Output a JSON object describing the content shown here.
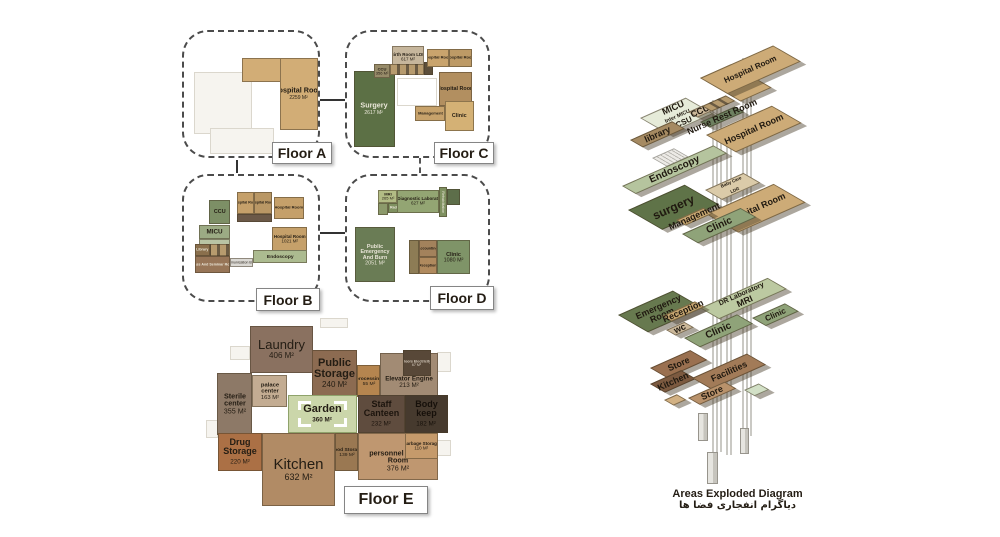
{
  "floor_a": {
    "label": "Floor A",
    "rooms": {
      "hospital_room": {
        "name": "Hospital Room",
        "area": "2259 M²"
      }
    }
  },
  "floor_b": {
    "label": "Floor B",
    "rooms": {
      "ccu": {
        "name": "CCU"
      },
      "micu": {
        "name": "MICU"
      },
      "hospital_room_1": {
        "name": "Hospital Room"
      },
      "hospital_room_2": {
        "name": "Hospital Room"
      },
      "hospital_room_3": {
        "name": "Hospital Room"
      },
      "hospital_room_4": {
        "name": "Hospital Room",
        "area": "1021 M²"
      },
      "library": {
        "name": "Library"
      },
      "class_seminar": {
        "name": "Class And Seminar Room"
      },
      "communication_bridge": {
        "name": "Communication Bridge"
      },
      "endoscopy": {
        "name": "Endoscopy"
      }
    }
  },
  "floor_c": {
    "label": "Floor C",
    "rooms": {
      "surgery": {
        "name": "Surgery",
        "area": "2617 M²"
      },
      "birth_room": {
        "name": "Birth Room LDR",
        "area": "617 M²"
      },
      "ccu": {
        "name": "CCU",
        "area": "356 M²"
      },
      "hospital_room_1": {
        "name": "Hospital Room"
      },
      "hospital_room_2": {
        "name": "Hospital Room"
      },
      "hospital_room_3": {
        "name": "Hospital Room"
      },
      "management": {
        "name": "Management"
      },
      "clinic": {
        "name": "Clinic"
      }
    }
  },
  "floor_d": {
    "label": "Floor D",
    "rooms": {
      "mri": {
        "name": "MRI",
        "area": "265 M²"
      },
      "radiology": {
        "name": "Radiology"
      },
      "diagnostic_lab": {
        "name": "Dr Diagnostic Laboratory",
        "area": "627 M²"
      },
      "rehabilitation": {
        "name": "Rehabilitation"
      },
      "emergency": {
        "name": "Public Emergency And Burn",
        "area": "2051 M²"
      },
      "accounting": {
        "name": "Accounting"
      },
      "reception": {
        "name": "Reception"
      },
      "clinic": {
        "name": "Clinic",
        "area": "1080 M²"
      }
    }
  },
  "floor_e": {
    "label": "Floor E",
    "rooms": {
      "laundry": {
        "name": "Laundry",
        "area": "406 M²"
      },
      "public_storage": {
        "name": "Public Storage",
        "area": "240 M²"
      },
      "processing": {
        "name": "processing",
        "area": "55 M²"
      },
      "floors_electricity": {
        "name": "Floors Electricity",
        "area": "67 M²"
      },
      "elevator_engine": {
        "name": "Elevator Engine",
        "area": "213 M²"
      },
      "sterile_center": {
        "name": "Sterile center",
        "area": "355 M²"
      },
      "palace_center": {
        "name": "palace center",
        "area": "163 M²"
      },
      "garden": {
        "name": "Garden",
        "area": "360 M²"
      },
      "staff_canteen": {
        "name": "Staff Canteen",
        "area": "232 M²"
      },
      "body_keep": {
        "name": "Body keep",
        "area": "182 M²"
      },
      "drug_storage": {
        "name": "Drug Storage",
        "area": "220 M²"
      },
      "kitchen": {
        "name": "Kitchen",
        "area": "632 M²"
      },
      "food_storage": {
        "name": "Food Storage",
        "area": "139 M²"
      },
      "personnel_locker": {
        "name": "personnel locker Room",
        "area": "376 M²"
      },
      "garbage_storage": {
        "name": "Garbage Storage",
        "area": "110 M²"
      }
    }
  },
  "exploded": {
    "title": "Areas  Exploded Diagram",
    "subtitle": "دیاگرام انفجاری فضا ها",
    "plates": {
      "hospital_room_top": "Hospital Room",
      "micu": "MICU",
      "inter_micu": "Inter MICU",
      "bicsu": "BICSU",
      "library": "library",
      "ccu": "CCU",
      "nurse_rest": "Nurse Rest Room",
      "hospital_room_2": "Hospital Room",
      "endoscopy": "Endoscopy",
      "surgery": "surgery",
      "baby_care_1": "Baby Care",
      "baby_care_2": "LDR",
      "hospital_room_3": "Hospital Room",
      "management": "Management",
      "clinic_1": "Clinic",
      "emergency_1": "Emergency",
      "emergency_2": "Room",
      "dr_lab": "DR Laboratory",
      "mri": "MRI",
      "clinic_2": "Clinic",
      "reception": "Reception",
      "wc": "wc",
      "clinic_3": "Clinic",
      "store_1": "Store",
      "kitchen": "Kitchen",
      "facilities": "Facilities",
      "store_2": "Store"
    }
  }
}
